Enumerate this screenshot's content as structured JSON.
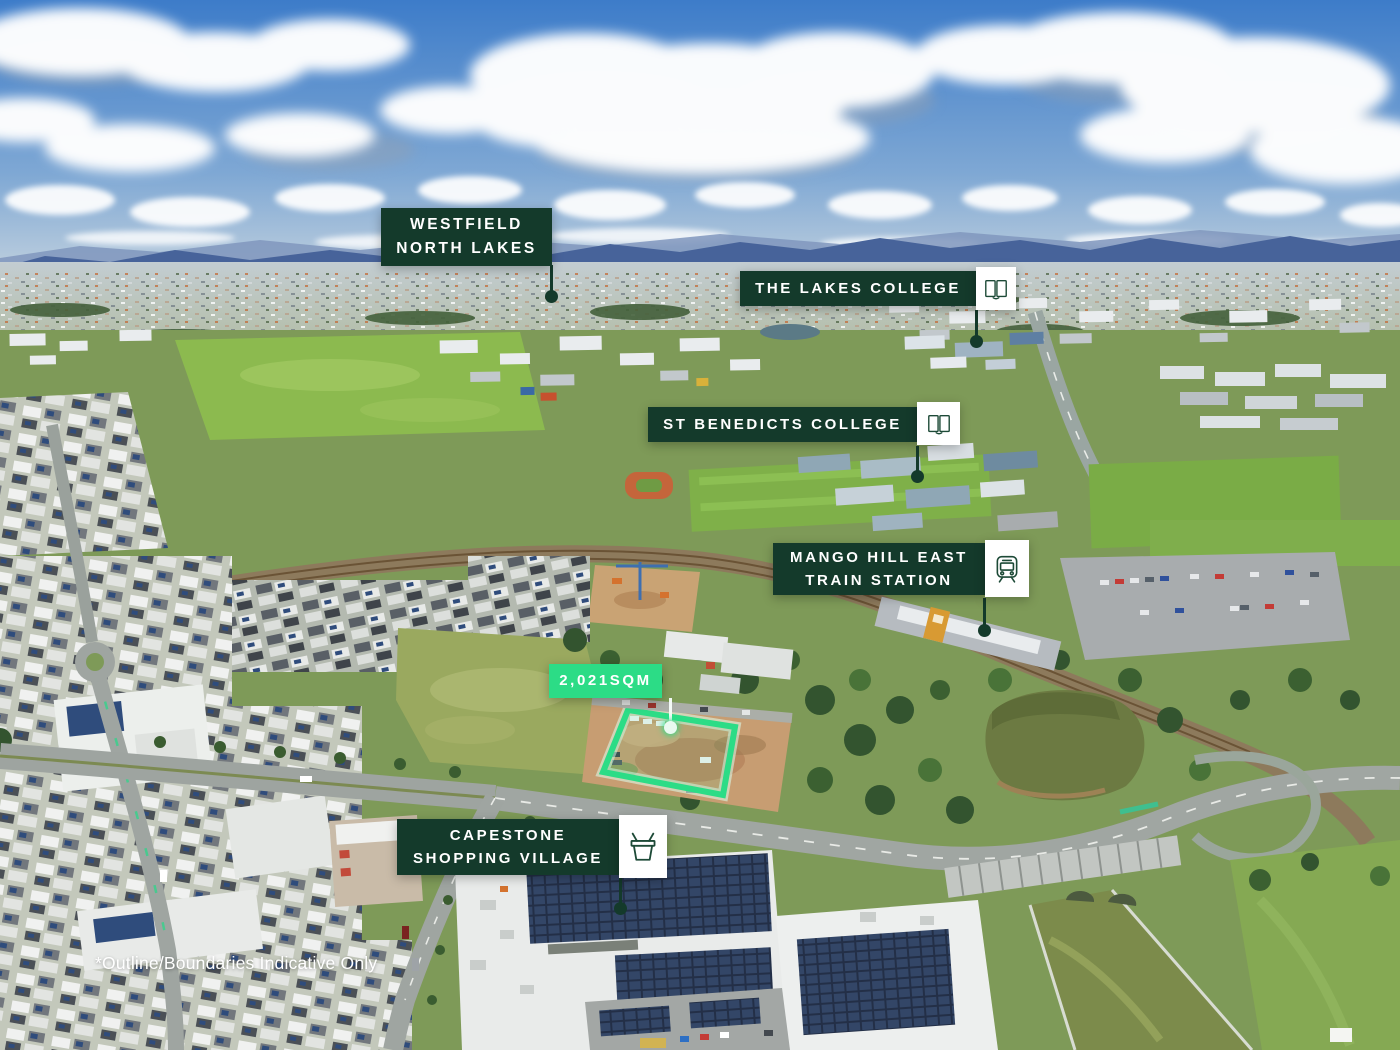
{
  "image": {
    "kind": "aerial-drone-photo-with-location-markers",
    "disclaimer": "*Outline/Boundaries Indicative Only"
  },
  "site": {
    "area_label": "2,021SQM"
  },
  "markers": {
    "westfield": {
      "line1": "WESTFIELD",
      "line2": "NORTH LAKES"
    },
    "lakes_college": {
      "line1": "THE LAKES COLLEGE",
      "icon": "open-book"
    },
    "st_benedicts": {
      "line1": "ST BENEDICTS COLLEGE",
      "icon": "open-book"
    },
    "mango_hill": {
      "line1": "MANGO HILL EAST",
      "line2": "TRAIN STATION",
      "icon": "train"
    },
    "capestone": {
      "line1": "CAPESTONE",
      "line2": "SHOPPING VILLAGE",
      "icon": "shopping-basket"
    }
  },
  "colors": {
    "label_background": "#143a2b",
    "accent_green": "#2cdc86",
    "label_text": "#ffffff",
    "icon_stroke": "#1d4a37"
  }
}
